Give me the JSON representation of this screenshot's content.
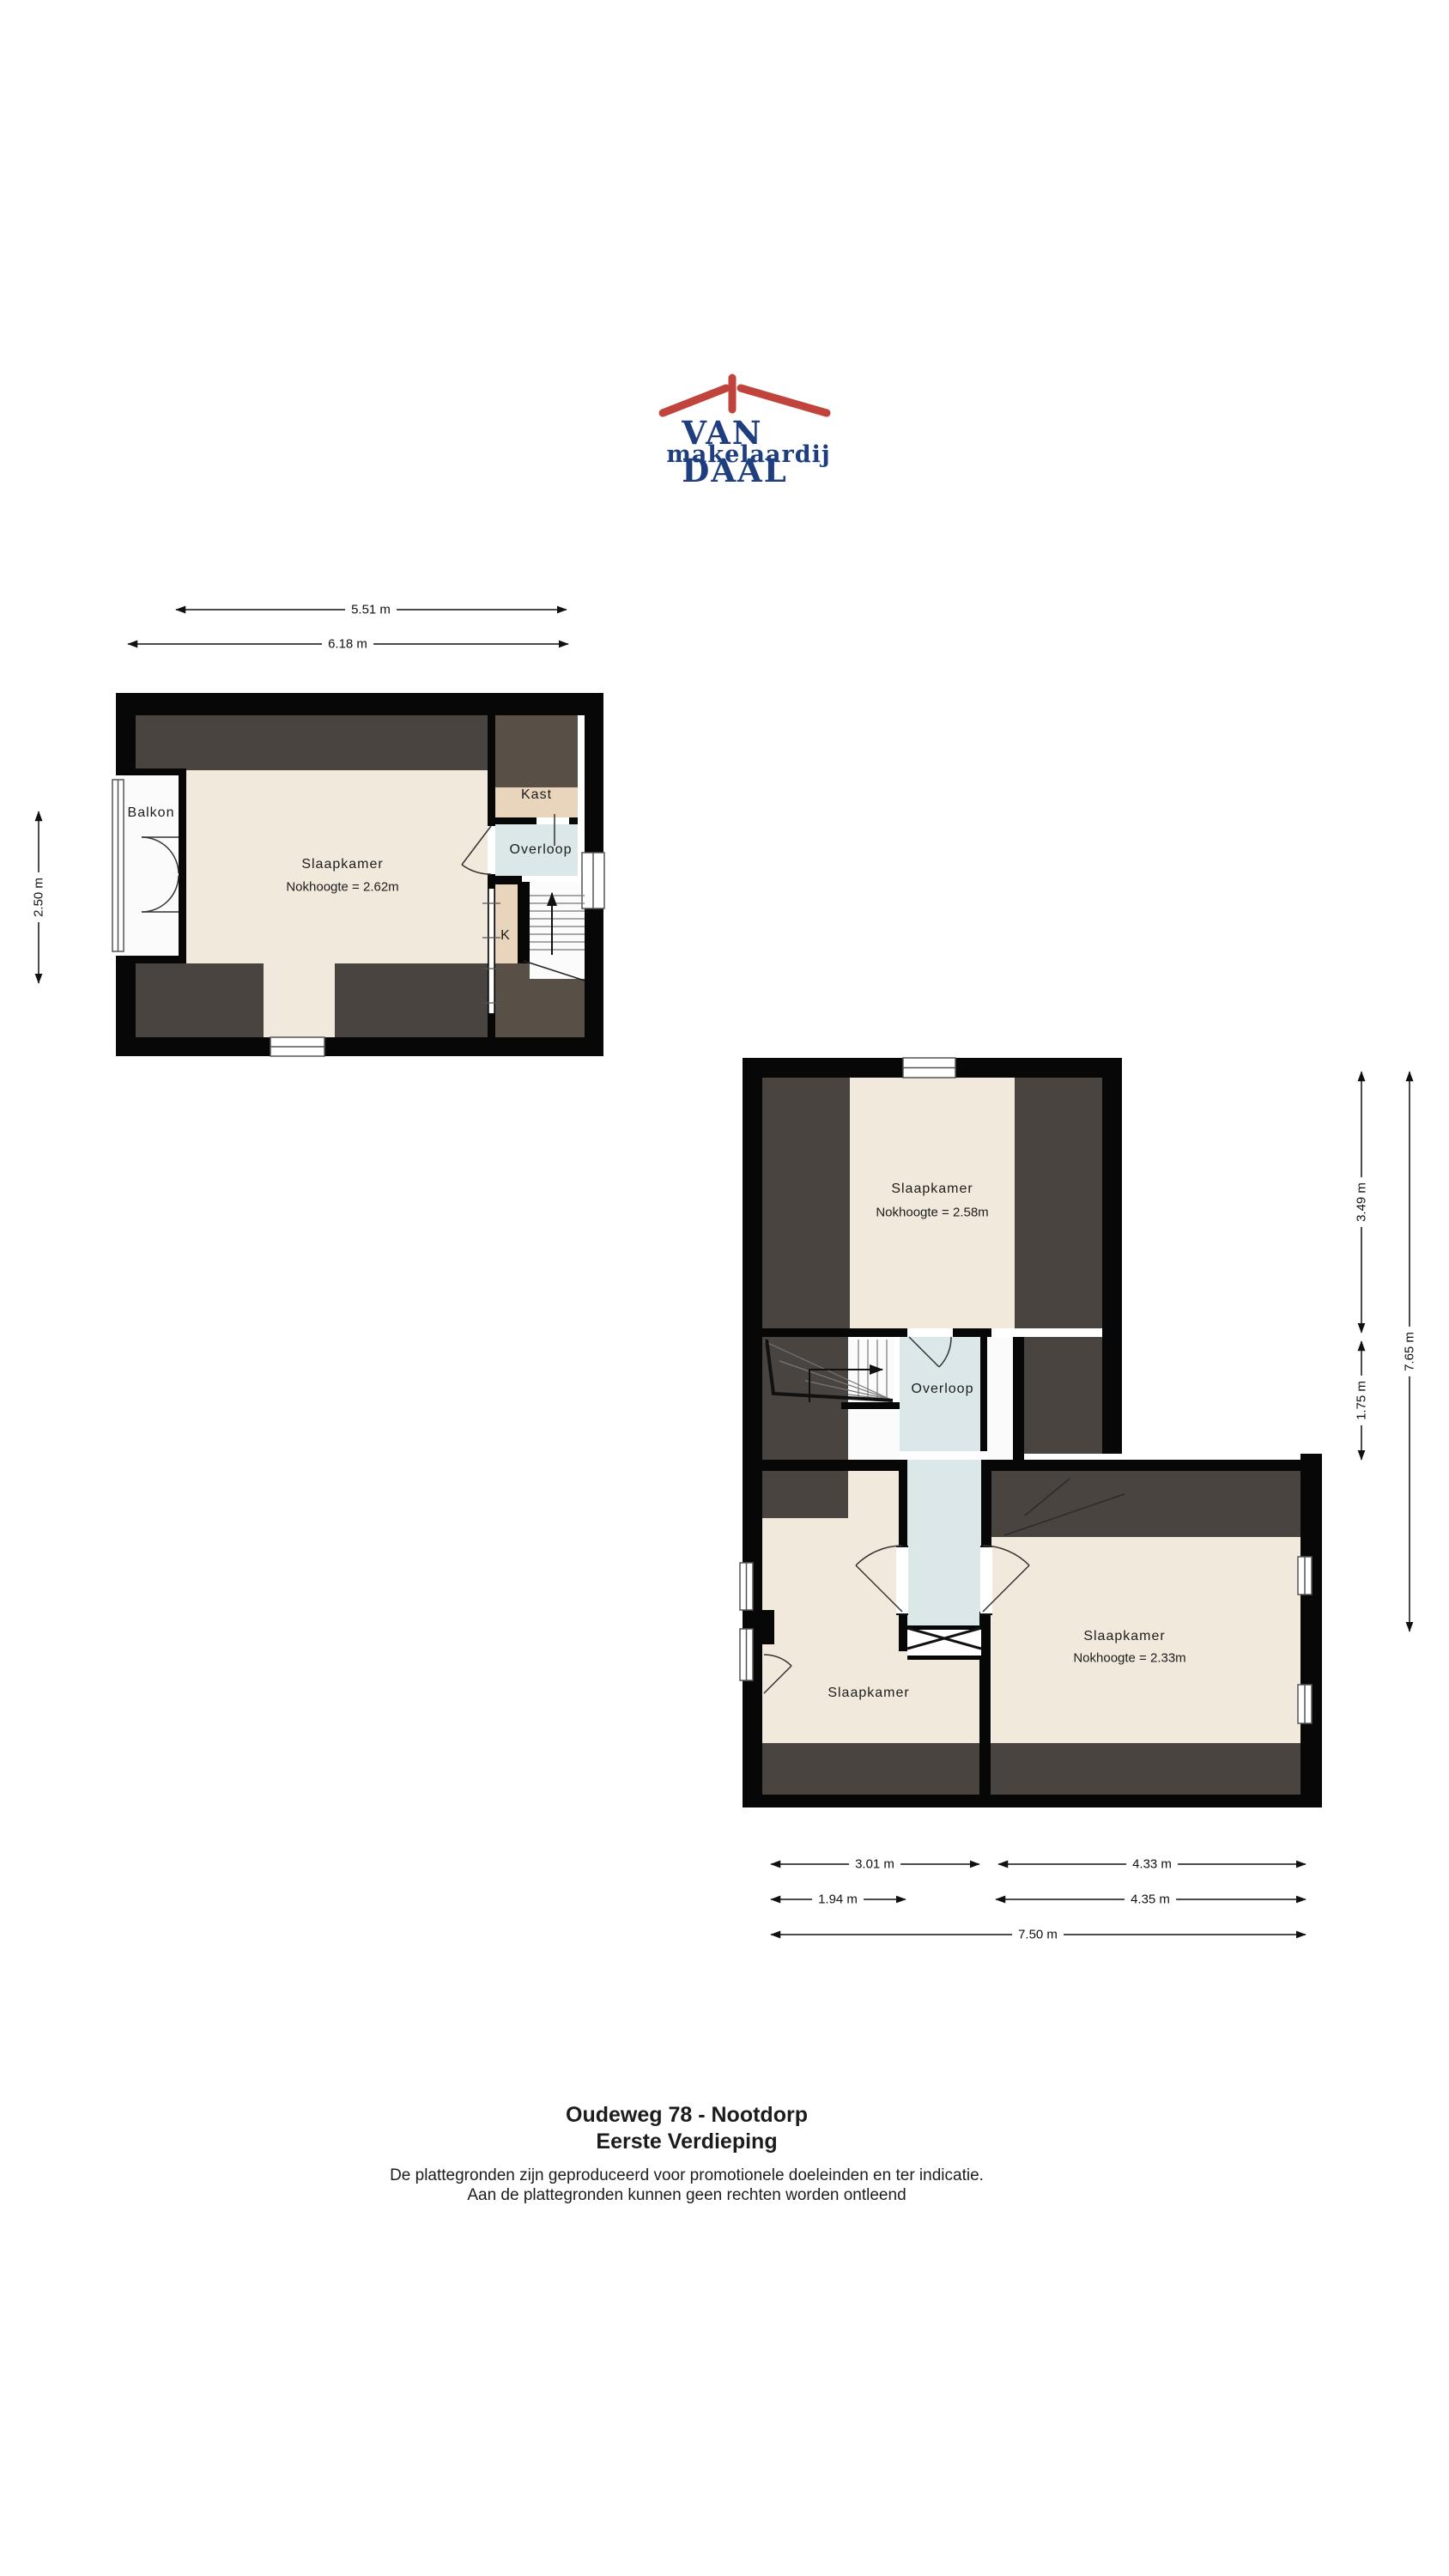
{
  "logo": {
    "name": "VAN DAAL",
    "tagline": "makelaardij",
    "brand_blue": "#1e3e7e",
    "brand_red": "#c0443b"
  },
  "plan1": {
    "labels": {
      "balkon": "Balkon",
      "slaapkamer": "Slaapkamer",
      "slaapkamer_sub": "Nokhoogte = 2.62m",
      "kast": "Kast",
      "overloop": "Overloop",
      "k": "K"
    },
    "dims": {
      "width_inner": "5.51 m",
      "width_outer": "6.18 m",
      "height_left": "2.50 m"
    }
  },
  "plan2": {
    "labels": {
      "slaapkamer_top": "Slaapkamer",
      "slaapkamer_top_sub": "Nokhoogte = 2.58m",
      "overloop": "Overloop",
      "slaapkamer_left": "Slaapkamer",
      "slaapkamer_right": "Slaapkamer",
      "slaapkamer_right_sub": "Nokhoogte = 2.33m"
    },
    "dims": {
      "right_top": "3.49 m",
      "right_mid": "1.75 m",
      "right_total": "7.65 m",
      "bottom_row1_left": "3.01 m",
      "bottom_row1_right": "4.33 m",
      "bottom_row2_left": "1.94 m",
      "bottom_row2_right": "4.35 m",
      "bottom_total": "7.50 m"
    }
  },
  "footer": {
    "title": "Oudeweg 78 - Nootdorp",
    "subtitle": "Eerste Verdieping",
    "disclaimer1": "De plattegronden zijn geproduceerd voor promotionele doeleinden en ter indicatie.",
    "disclaimer2": "Aan de plattegronden kunnen geen rechten worden ontleend"
  },
  "colors": {
    "wall": "#070707",
    "sloped_ceiling": "#4a4440",
    "sloped_ceiling_warm": "#584f47",
    "floor_cream": "#f1e9dc",
    "closet_beige": "#e8d5bc",
    "landing_blue": "#dbe7e9"
  }
}
